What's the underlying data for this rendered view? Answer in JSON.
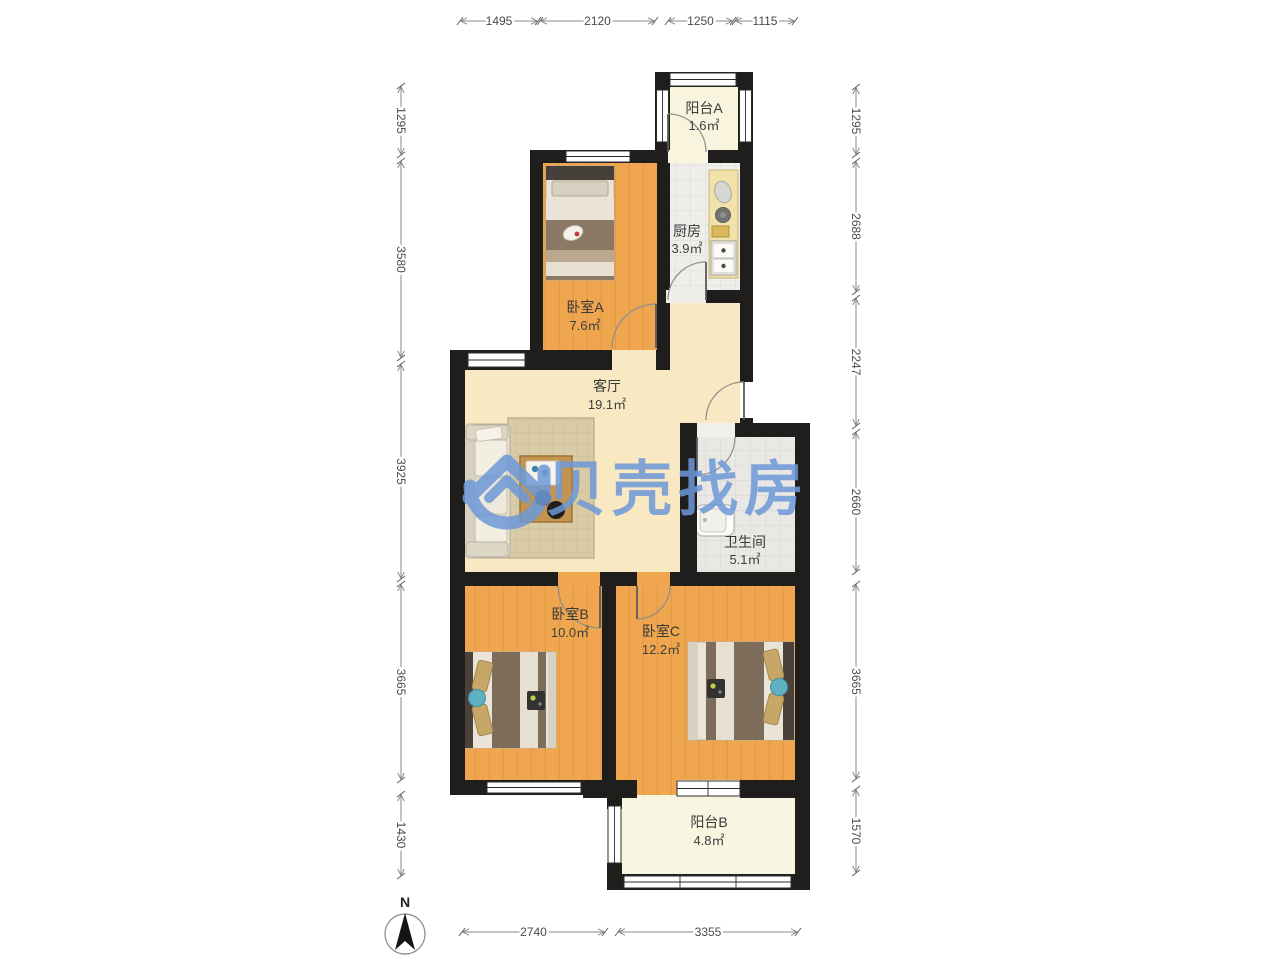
{
  "watermark": {
    "text": "贝壳找房",
    "color": "#6d99d8"
  },
  "compass": {
    "label": "N"
  },
  "rooms": [
    {
      "id": "balcony-a",
      "name": "阳台A",
      "area": "1.6㎡"
    },
    {
      "id": "kitchen",
      "name": "厨房",
      "area": "3.9㎡"
    },
    {
      "id": "bedroom-a",
      "name": "卧室A",
      "area": "7.6㎡"
    },
    {
      "id": "living-room",
      "name": "客厅",
      "area": "19.1㎡"
    },
    {
      "id": "bathroom",
      "name": "卫生间",
      "area": "5.1㎡"
    },
    {
      "id": "bedroom-b",
      "name": "卧室B",
      "area": "10.0㎡"
    },
    {
      "id": "bedroom-c",
      "name": "卧室C",
      "area": "12.2㎡"
    },
    {
      "id": "balcony-b",
      "name": "阳台B",
      "area": "4.8㎡"
    }
  ],
  "dimensions": {
    "rows": [
      {
        "side": "top",
        "orient": "h",
        "pos": 21,
        "items": [
          {
            "label": "1495",
            "from": 460,
            "to": 538
          },
          {
            "label": "2120",
            "from": 540,
            "to": 655
          },
          {
            "label": "1250",
            "from": 668,
            "to": 733
          },
          {
            "label": "1115",
            "from": 735,
            "to": 795
          }
        ]
      },
      {
        "side": "bottom",
        "orient": "h",
        "pos": 932,
        "items": [
          {
            "label": "2740",
            "from": 462,
            "to": 605
          },
          {
            "label": "3355",
            "from": 618,
            "to": 798
          }
        ]
      },
      {
        "side": "left",
        "orient": "v",
        "pos": 401,
        "items": [
          {
            "label": "1295",
            "from": 86,
            "to": 155
          },
          {
            "label": "3580",
            "from": 161,
            "to": 358
          },
          {
            "label": "3925",
            "from": 364,
            "to": 579
          },
          {
            "label": "3665",
            "from": 584,
            "to": 780
          },
          {
            "label": "1430",
            "from": 794,
            "to": 876
          }
        ]
      },
      {
        "side": "right",
        "orient": "v",
        "pos": 856,
        "items": [
          {
            "label": "1295",
            "from": 87,
            "to": 155
          },
          {
            "label": "2688",
            "from": 161,
            "to": 292
          },
          {
            "label": "2247",
            "from": 298,
            "to": 426
          },
          {
            "label": "2660",
            "from": 432,
            "to": 572
          },
          {
            "label": "3665",
            "from": 584,
            "to": 779
          },
          {
            "label": "1570",
            "from": 789,
            "to": 873
          }
        ]
      }
    ]
  },
  "colors": {
    "wall": "#201e1c",
    "wood_floor": "#f0a64e",
    "living_floor": "#f8e9c3",
    "kitchen_floor": "#efeeeb",
    "bathroom_floor": "#e9e8e4",
    "balcony_floor": "#f8f4de",
    "watermark_blue": "#6d99d8",
    "dimension_text": "#4a4a4a"
  }
}
